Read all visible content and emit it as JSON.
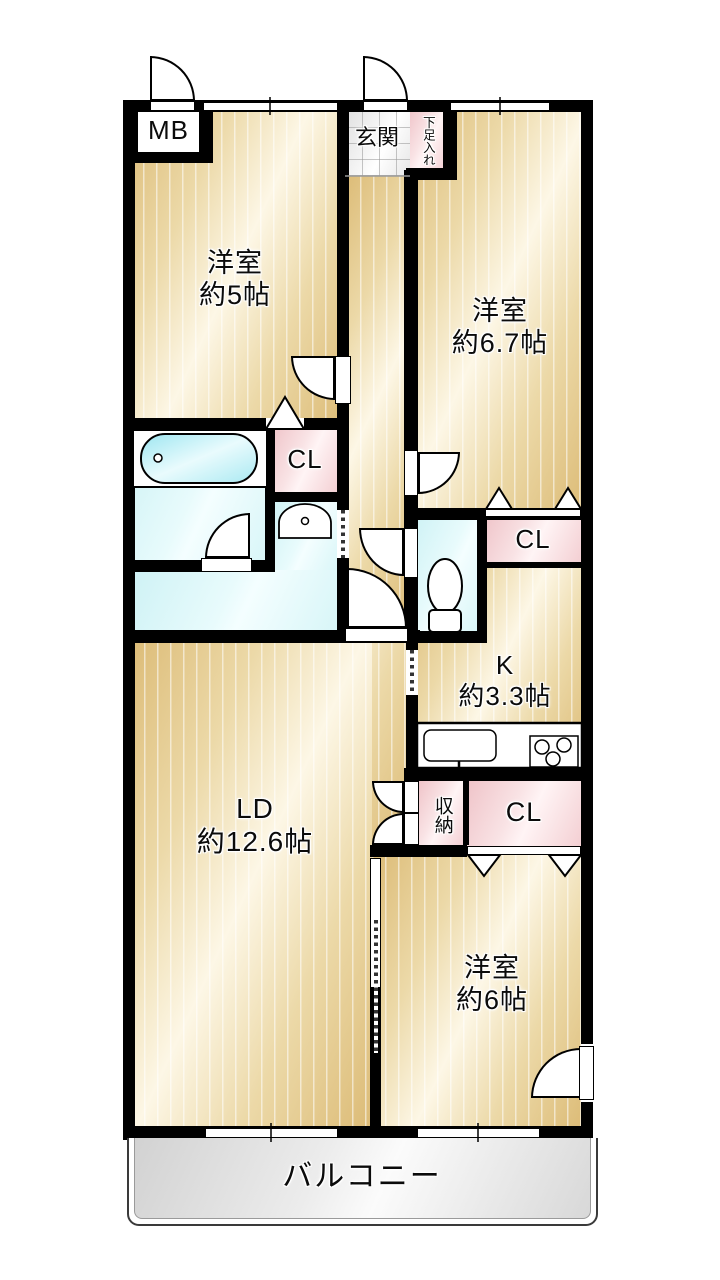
{
  "floorplan": {
    "mb": {
      "label": "MB"
    },
    "genkan": {
      "label": "玄関"
    },
    "shoebox": {
      "label": "下足入れ"
    },
    "bedroom1": {
      "name": "洋室",
      "size": "約5帖"
    },
    "bedroom2": {
      "name": "洋室",
      "size": "約6.7帖"
    },
    "bedroom3": {
      "name": "洋室",
      "size": "約6帖"
    },
    "living": {
      "name": "LD",
      "size": "約12.6帖"
    },
    "kitchen": {
      "name": "K",
      "size": "約3.3帖"
    },
    "closet1": {
      "label": "CL"
    },
    "closet2": {
      "label": "CL"
    },
    "closet3": {
      "label": "CL"
    },
    "storage": {
      "label": "収納"
    },
    "balcony": {
      "label": "バルコニー"
    },
    "colors": {
      "wall": "#000000",
      "room_floor": "#ecd9a8",
      "closet_pink": "#f5d0d4",
      "wet_area_cyan": "#dcf6f8",
      "bathtub": "#a5e8f1",
      "genkan_tile": "#ededed",
      "balcony_gray": "#e0e0e0"
    }
  }
}
